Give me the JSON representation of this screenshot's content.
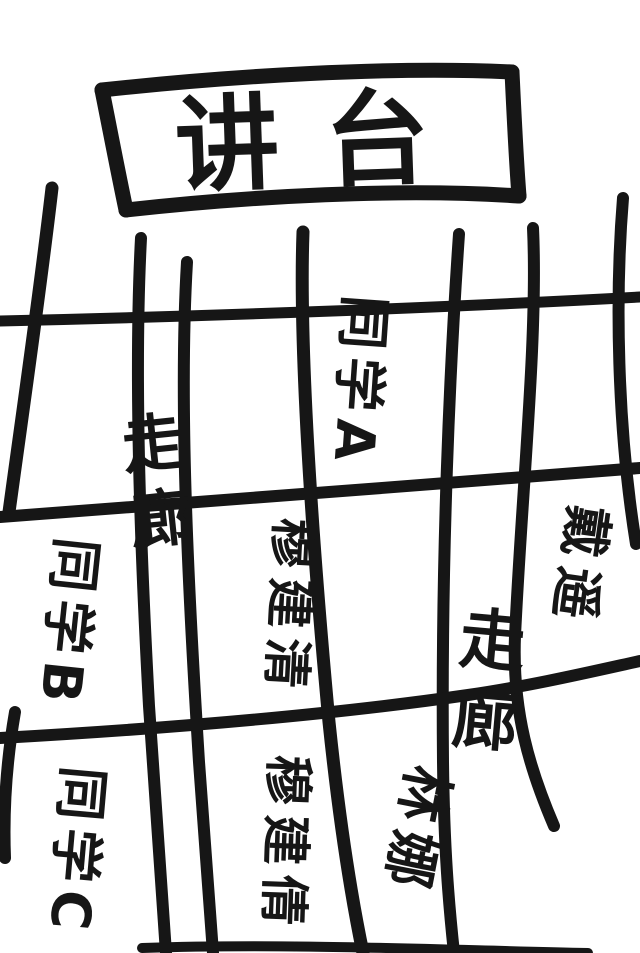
{
  "podium": {
    "label": "讲台"
  },
  "cells": [
    {
      "id": "seat-classmate-a",
      "label": "同学A",
      "type": "seat",
      "orientation": "sideways"
    },
    {
      "id": "corridor-left",
      "label": "走廊",
      "type": "corridor",
      "orientation": "vertical"
    },
    {
      "id": "seat-classmate-b",
      "label": "同学B",
      "type": "seat",
      "orientation": "sideways"
    },
    {
      "id": "seat-mu-jianqing1",
      "label": "穆建清",
      "type": "seat",
      "orientation": "sideways"
    },
    {
      "id": "seat-dai-yao",
      "label": "戴遥",
      "type": "seat",
      "orientation": "sideways"
    },
    {
      "id": "corridor-right",
      "label": "走廊",
      "type": "corridor",
      "orientation": "vertical"
    },
    {
      "id": "seat-lin-na",
      "label": "林娜",
      "type": "seat",
      "orientation": "sideways"
    },
    {
      "id": "seat-mu-jianqian",
      "label": "穆建倩",
      "type": "seat",
      "orientation": "sideways"
    },
    {
      "id": "seat-classmate-c",
      "label": "同学C",
      "type": "seat",
      "orientation": "sideways"
    }
  ],
  "colors": {
    "ink": "#161616",
    "paper": "#ffffff"
  }
}
